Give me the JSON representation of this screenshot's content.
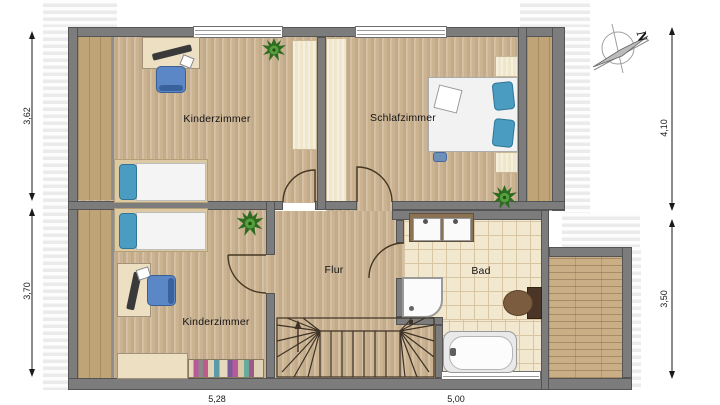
{
  "plan": {
    "type": "floor-plan",
    "rooms": [
      {
        "name": "Kinderzimmer"
      },
      {
        "name": "Schlafzimmer"
      },
      {
        "name": "Kinderzimmer"
      },
      {
        "name": "Flur"
      },
      {
        "name": "Bad"
      }
    ],
    "dimensions": {
      "left_top": "3,62",
      "left_bottom": "3,70",
      "right_top": "4,10",
      "right_bottom": "3,50",
      "bottom_left": "5,28",
      "bottom_right": "5,00"
    },
    "compass": {
      "north_label": "N"
    },
    "colors": {
      "wall": "#7c7c7c",
      "floor_wood": "#cbb392",
      "tile": "#f2e7cf",
      "deck": "#bfa478",
      "pale_strip": "#f0e6cb",
      "pillow_blue": "#4a9cc0",
      "chair_blue": "#5b87c7",
      "plant_green": "#3f7d2e"
    }
  }
}
